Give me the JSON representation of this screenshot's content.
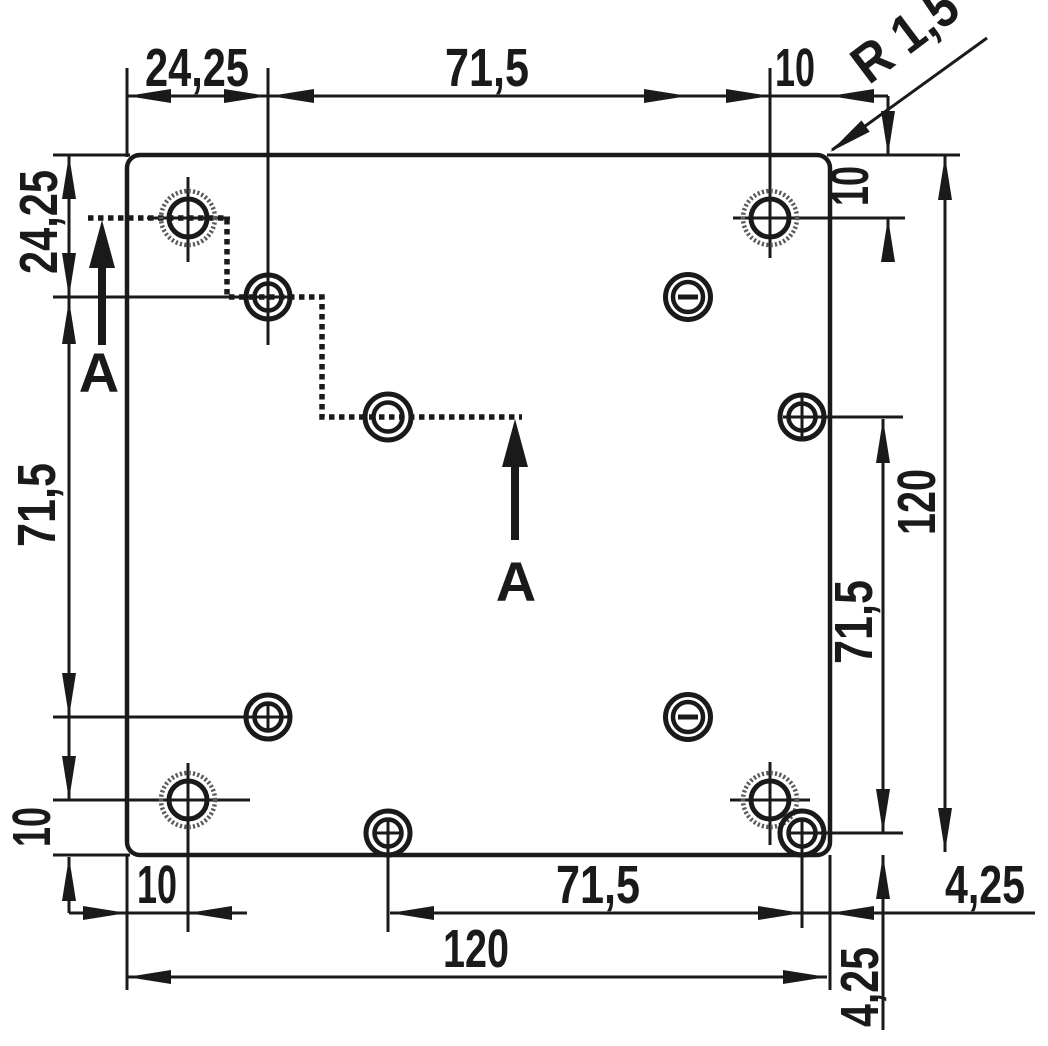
{
  "drawing": {
    "type": "technical-dimension-drawing",
    "units": "mm (decimal comma notation)",
    "labels": {
      "section": "A",
      "corner_radius": "R 1,5"
    },
    "dims": {
      "top_left_width": "24,25",
      "top_center_width": "71,5",
      "top_right_width": "10",
      "right_top_offset": "10",
      "right_total_height": "120",
      "right_hole_spacing": "71,5",
      "left_top_offset": "24,25",
      "left_hole_spacing": "71,5",
      "left_bottom_offset": "10",
      "bottom_left_offset": "10",
      "bottom_hole_spacing": "71,5",
      "bottom_total_width": "120",
      "bottom_right_offset_horizontal": "4,25",
      "bottom_right_offset_vertical": "4,25"
    },
    "plate": {
      "width_label": "120",
      "height_label": "120",
      "corner_radius_label": "R 1,5"
    },
    "holes": [
      {
        "type": "countersunk-hatched",
        "position": "top-left"
      },
      {
        "type": "countersunk-hatched",
        "position": "top-right"
      },
      {
        "type": "countersunk-hatched",
        "position": "bottom-left"
      },
      {
        "type": "countersunk-hatched",
        "position": "bottom-right"
      },
      {
        "type": "counterbore-crosshair",
        "position": "upper-left-inner"
      },
      {
        "type": "counterbore-plain",
        "position": "center-left"
      },
      {
        "type": "counterbore-plus",
        "position": "center-right-edge"
      },
      {
        "type": "counterbore-plus",
        "position": "lower-left-inner"
      },
      {
        "type": "counterbore-plus",
        "position": "bottom-center"
      },
      {
        "type": "counterbore-plus",
        "position": "bottom-right-edge"
      },
      {
        "type": "slotted-minus",
        "position": "upper-right-inner"
      },
      {
        "type": "slotted-minus",
        "position": "lower-right-inner"
      }
    ],
    "section_cut": {
      "label": "A",
      "style": "stepped dotted line through three holes"
    }
  }
}
